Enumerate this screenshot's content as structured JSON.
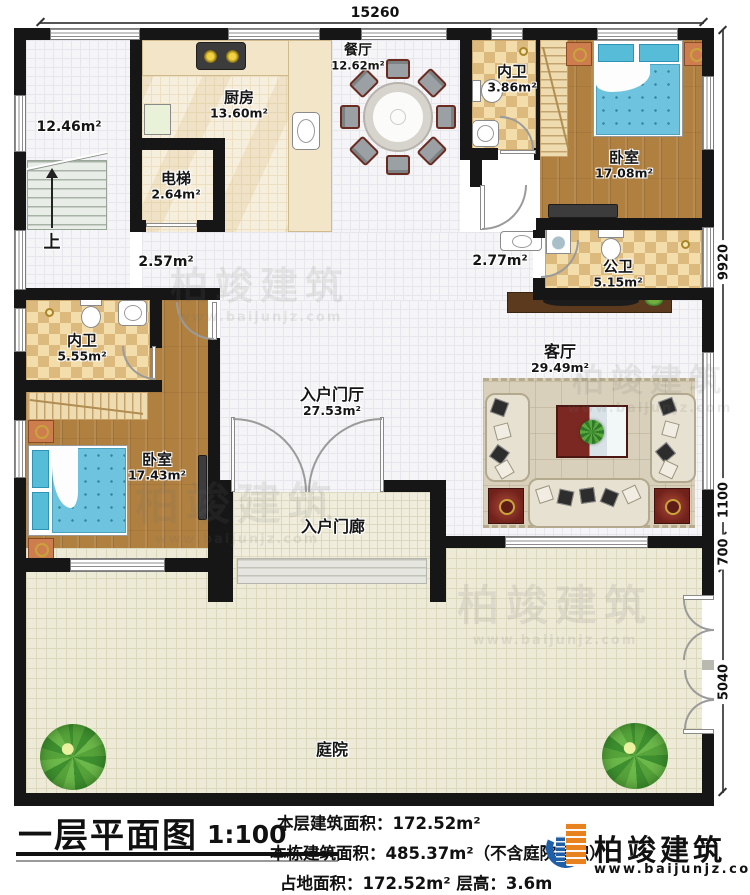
{
  "dims": {
    "top": "15260",
    "right_upper": "9920",
    "right_mid1": "1100",
    "right_mid2": "700",
    "right_lower": "5040"
  },
  "rooms": {
    "stair_hall": {
      "area": "12.46m²",
      "up": "上"
    },
    "kitchen": {
      "name": "厨房",
      "area": "13.60m²"
    },
    "elevator": {
      "name": "电梯",
      "area": "2.64m²"
    },
    "dining": {
      "name": "餐厅",
      "area": "12.62m²"
    },
    "ensuite1": {
      "name": "内卫",
      "area": "3.86m²"
    },
    "bedroom1": {
      "name": "卧室",
      "area": "17.08m²"
    },
    "public_bath": {
      "name": "公卫",
      "area": "5.15m²"
    },
    "hall_a": {
      "area": "2.57m²"
    },
    "hall_b": {
      "area": "2.77m²"
    },
    "ensuite2": {
      "name": "内卫",
      "area": "5.55m²"
    },
    "bedroom2": {
      "name": "卧室",
      "area": "17.43m²"
    },
    "foyer": {
      "name": "入户门厅",
      "area": "27.53m²"
    },
    "living": {
      "name": "客厅",
      "area": "29.49m²"
    },
    "porch": {
      "name": "入户门廊"
    },
    "courtyard": {
      "name": "庭院"
    }
  },
  "title_block": {
    "title": "一层平面图",
    "scale": "1:100",
    "line1": "本层建筑面积：172.52m²",
    "line2": "本栋建筑面积：485.37m²（不含庭院面积）",
    "line3": "占地面积：172.52m²  层高：3.6m"
  },
  "logo": {
    "brand": "柏竣建筑",
    "site": "www.baijunjz.com"
  },
  "watermark": {
    "brand": "柏竣建筑",
    "site": "www.baijunjz.com"
  },
  "colors": {
    "wall": "#161616",
    "wood": "#b08040",
    "tile_bath": "#dcb97c",
    "bed": "#6ec4de",
    "accent_red": "#7c2822",
    "logo_blue": "#1f5fa8",
    "logo_orange": "#e8821e"
  }
}
